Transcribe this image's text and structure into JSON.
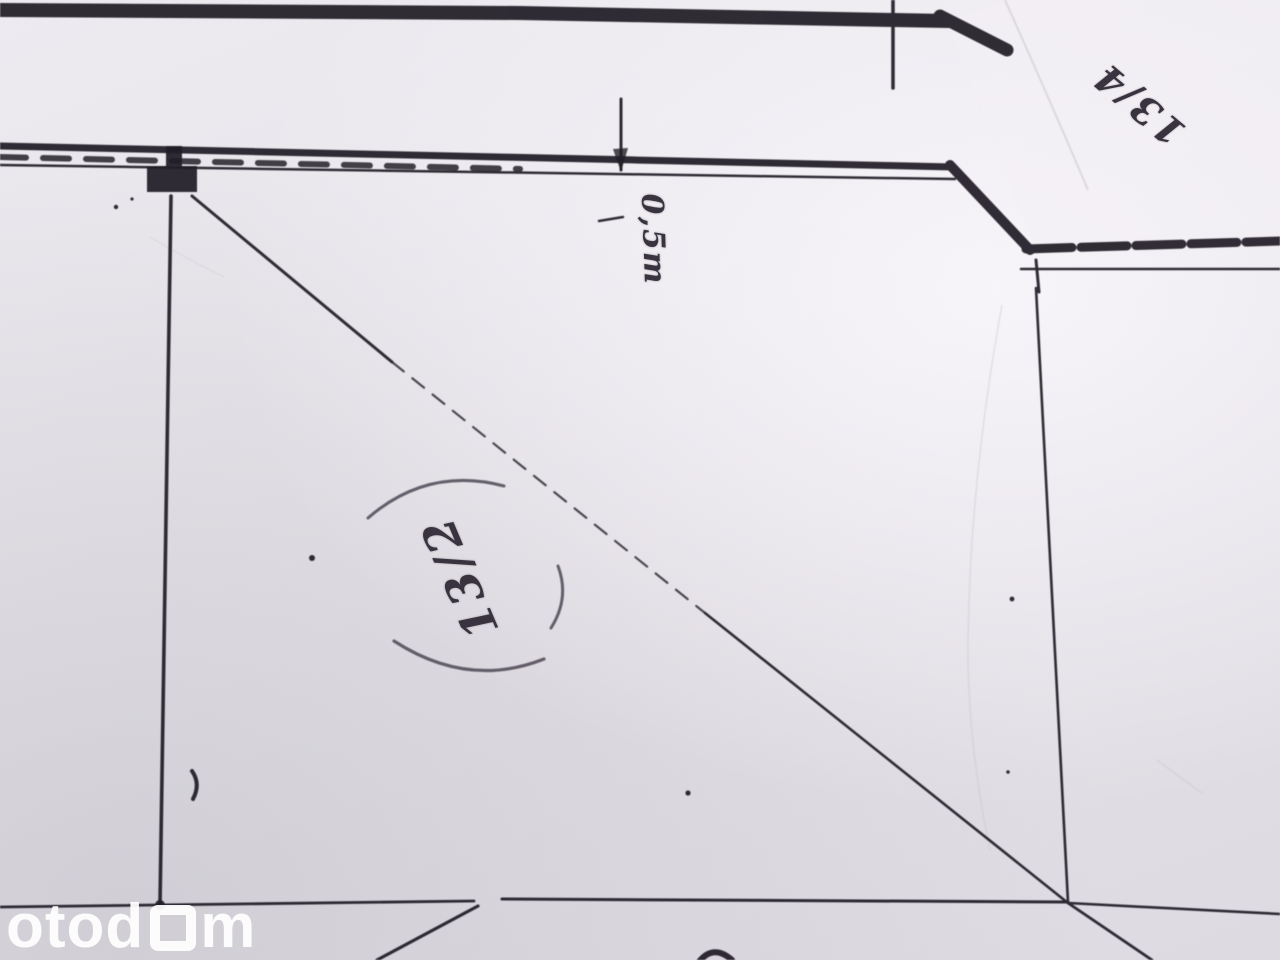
{
  "annotations": {
    "parcel_label_center": "13/2",
    "parcel_label_topright": "13/4",
    "measurement_label": "0,5m"
  },
  "watermark": {
    "prefix": "otod",
    "suffix": "m"
  },
  "colors": {
    "ink": "#211d26",
    "stamp_ink": "#443e4b",
    "paper": "#e6e3e9",
    "watermark": "#ffffff"
  }
}
